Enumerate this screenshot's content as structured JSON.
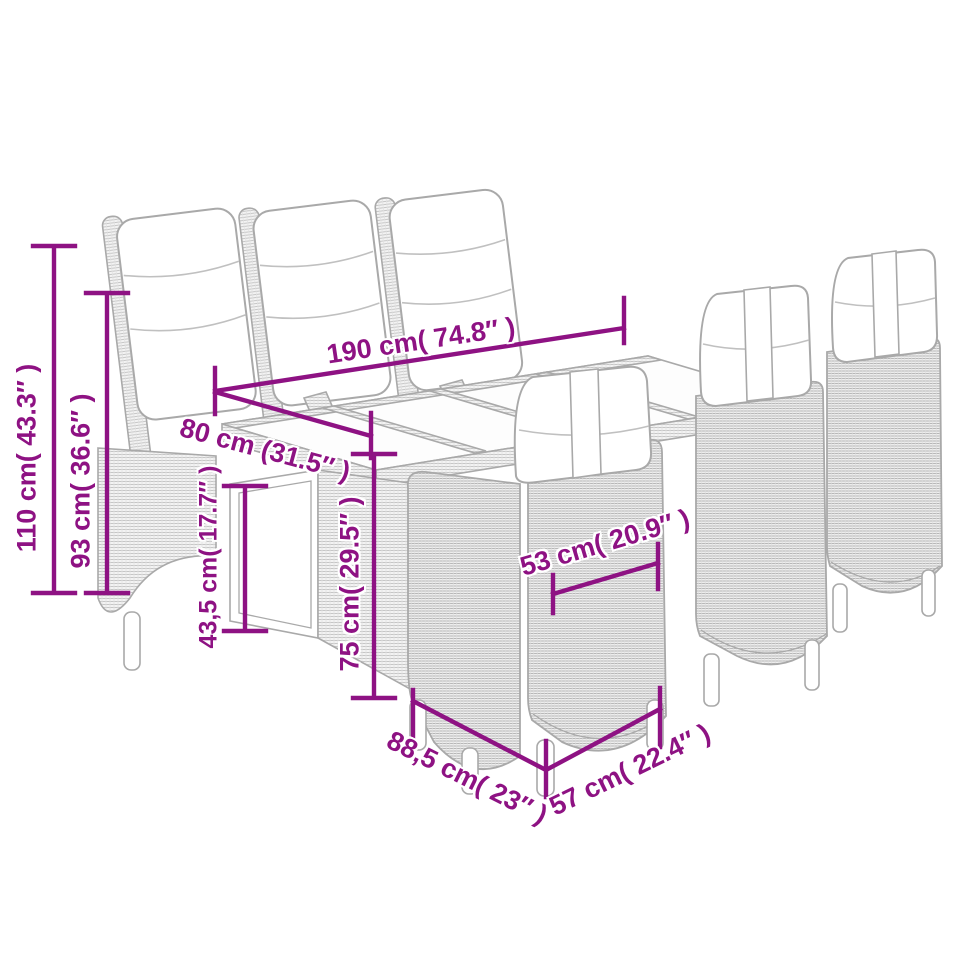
{
  "scene": {
    "name": "garden-dining-furniture-dimension-diagram"
  },
  "style": {
    "background": "#ffffff",
    "dimension_color": "#8e1283",
    "furniture_outline": "#a9a9a9",
    "furniture_outline_soft": "#c0c0c0",
    "cushion_fill": "#ffffff"
  },
  "dims": [
    {
      "id": "total-height",
      "label": "110 cm( 43.3″ )",
      "value_cm": "110",
      "value_in": "43.3"
    },
    {
      "id": "back-height",
      "label": "93 cm( 36.6″ )",
      "value_cm": "93",
      "value_in": "36.6"
    },
    {
      "id": "table-length",
      "label": "190 cm( 74.8″ )",
      "value_cm": "190",
      "value_in": "74.8"
    },
    {
      "id": "table-width",
      "label": "80 cm (31.5″ )",
      "value_cm": "80",
      "value_in": "31.5"
    },
    {
      "id": "shelf-height",
      "label": "43,5 cm( 17.7″ )",
      "value_cm": "43,5",
      "value_in": "17.7"
    },
    {
      "id": "table-height",
      "label": "75 cm( 29.5″ )",
      "value_cm": "75",
      "value_in": "29.5"
    },
    {
      "id": "seat-width",
      "label": "53 cm( 20.9″ )",
      "value_cm": "53",
      "value_in": "20.9"
    },
    {
      "id": "chair-depth",
      "label": "88,5 cm( 23″ )",
      "value_cm": "88,5",
      "value_in": "23"
    },
    {
      "id": "chair-width",
      "label": "57 cm( 22.4″ )",
      "value_cm": "57",
      "value_in": "22.4"
    }
  ]
}
